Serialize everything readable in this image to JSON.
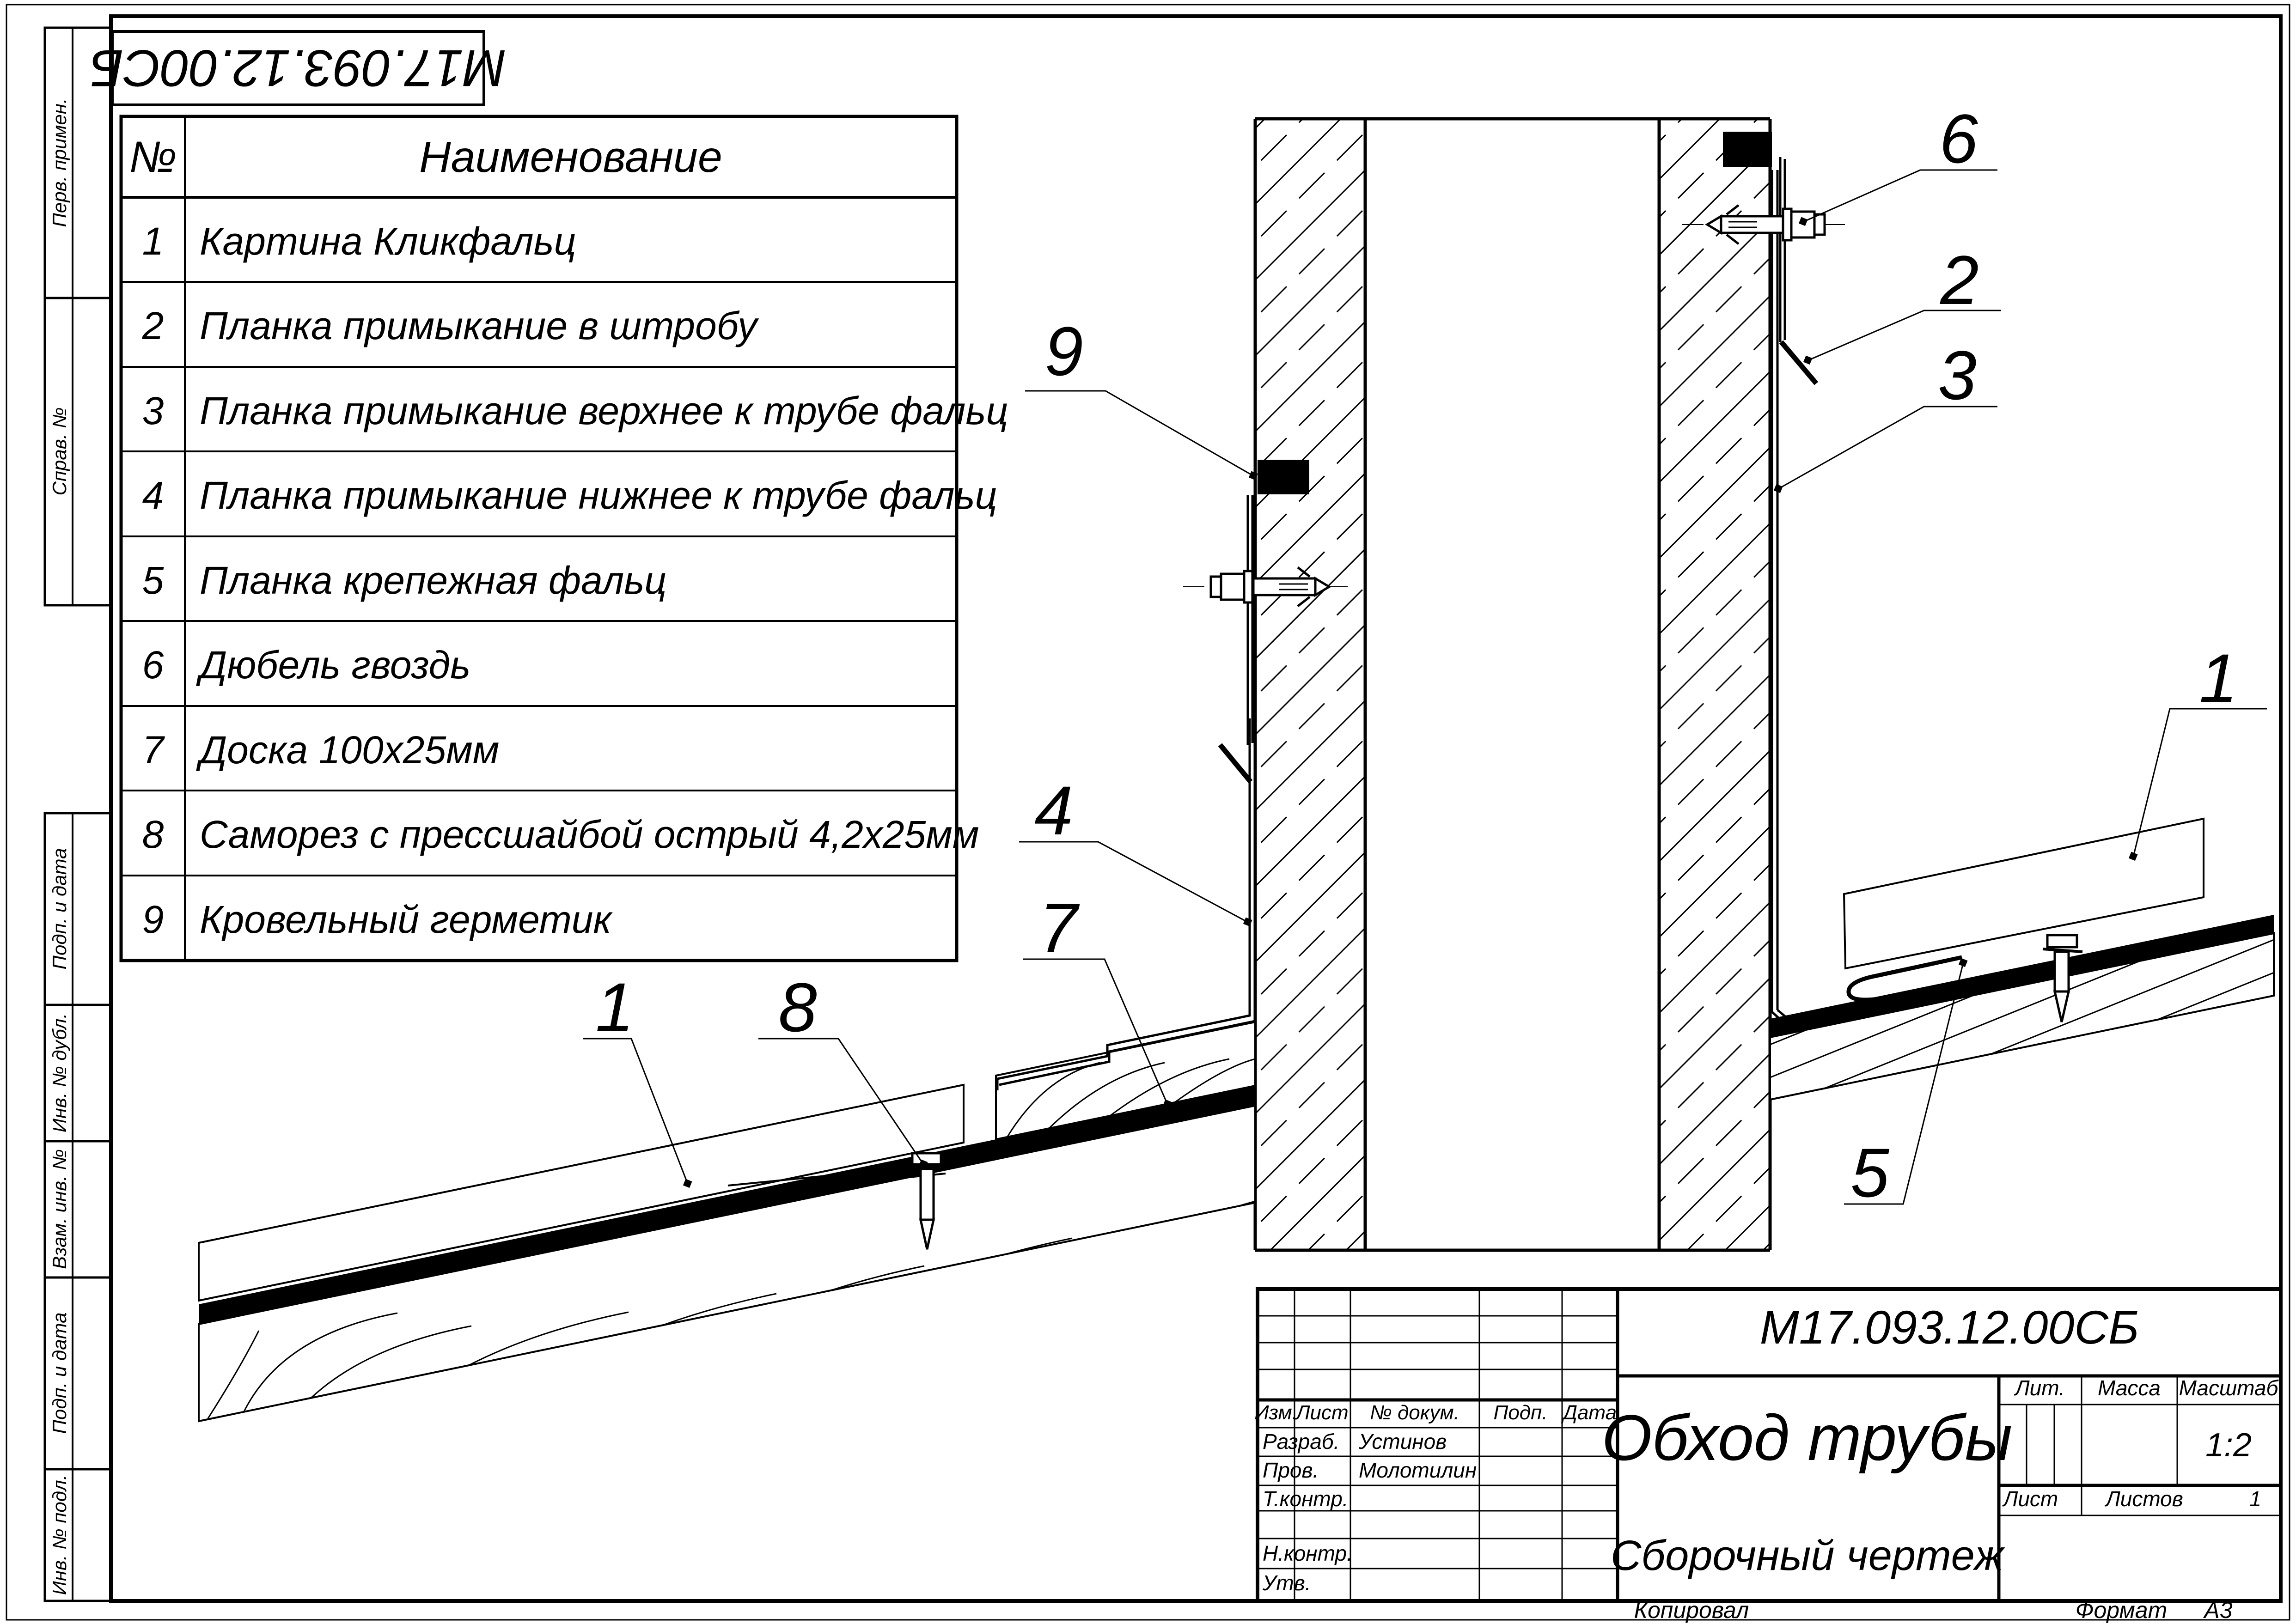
{
  "stamp": {
    "code": "М17.093.12.00СБ"
  },
  "margin_labels": {
    "perv": "Перв. примен.",
    "sprav": "Справ. №",
    "podp1": "Подп. и дата",
    "inv_dubl": "Инв. № дубл.",
    "vzam": "Взам. инв. №",
    "podp2": "Подп. и дата",
    "inv_podl": "Инв. № подл."
  },
  "parts_table": {
    "col_num": "№",
    "col_name": "Наименование",
    "rows": [
      {
        "num": "1",
        "name": "Картина Кликфальц"
      },
      {
        "num": "2",
        "name": "Планка примыкание в штробу"
      },
      {
        "num": "3",
        "name": "Планка примыкание верхнее к трубе фальц"
      },
      {
        "num": "4",
        "name": "Планка примыкание нижнее к трубе фальц"
      },
      {
        "num": "5",
        "name": "Планка крепежная фальц"
      },
      {
        "num": "6",
        "name": "Дюбель гвоздь"
      },
      {
        "num": "7",
        "name": "Доска 100х25мм"
      },
      {
        "num": "8",
        "name": "Саморез с прессшайбой острый 4,2х25мм"
      },
      {
        "num": "9",
        "name": "Кровельный герметик"
      }
    ]
  },
  "callouts": {
    "c9": "9",
    "c6": "6",
    "c2": "2",
    "c3": "3",
    "c1_right": "1",
    "c5": "5",
    "c4": "4",
    "c7": "7",
    "c8": "8",
    "c1_left": "1"
  },
  "title_block": {
    "doc_number": "М17.093.12.00СБ",
    "title": "Обход трубы",
    "subtitle": "Сборочный чертеж",
    "header": {
      "izm": "Изм.",
      "list": "Лист",
      "doc": "№ докум.",
      "podp": "Подп.",
      "data": "Дата"
    },
    "roles": {
      "razrab": "Разраб.",
      "prov": "Пров.",
      "tkontr": "Т.контр.",
      "nkontr": "Н.контр.",
      "utv": "Утв."
    },
    "people": {
      "razrab": "Устинов",
      "prov": "Молотилин"
    },
    "lit_label": "Лит.",
    "massa_label": "Масса",
    "masshtab_label": "Масштаб",
    "scale": "1:2",
    "list_label": "Лист",
    "listov_label": "Листов",
    "listov_value": "1"
  },
  "footer": {
    "kopiroval": "Копировал",
    "format_label": "Формат",
    "format_value": "А3"
  }
}
